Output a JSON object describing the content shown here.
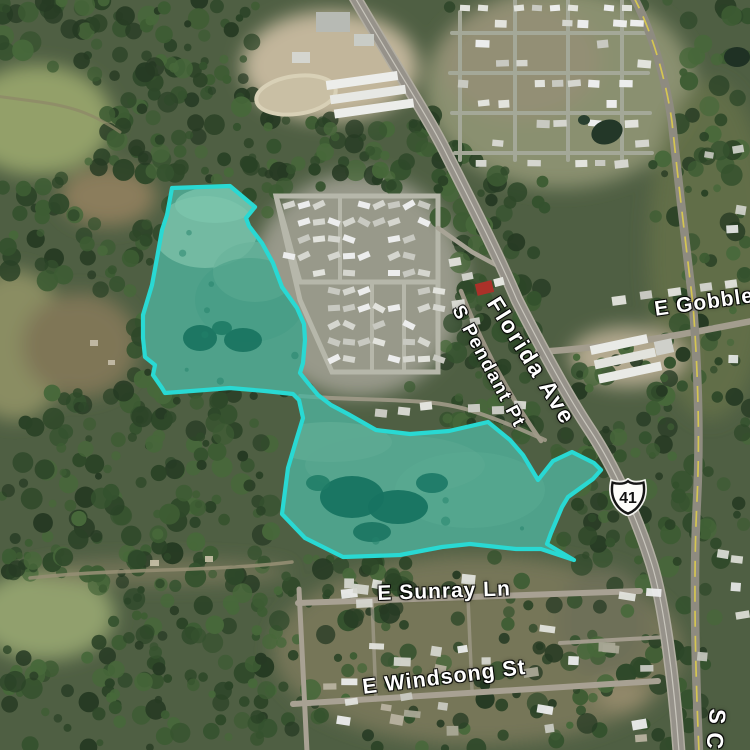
{
  "map": {
    "view": "satellite",
    "labels": {
      "florida_ave": "Florida Ave",
      "s_pendant_pt": "S Pendant Pt",
      "e_gobbler": "E Gobbler",
      "e_sunray_ln": "E Sunray Ln",
      "e_windsong_st": "E Windsong St",
      "s_street_partial": "S C",
      "route_shield_number": "41"
    },
    "overlay": {
      "description": "highlighted wetland parcel, two connected lobes",
      "stroke_color": "#29d9d3",
      "stroke_width": 4.2,
      "fill_color": "rgba(0,205,185,0.40)",
      "points": [
        [
          172,
          188
        ],
        [
          230,
          186
        ],
        [
          255,
          207
        ],
        [
          246,
          218
        ],
        [
          249,
          226
        ],
        [
          262,
          243
        ],
        [
          273,
          263
        ],
        [
          282,
          287
        ],
        [
          297,
          308
        ],
        [
          304,
          324
        ],
        [
          305,
          340
        ],
        [
          303,
          363
        ],
        [
          300,
          373
        ],
        [
          308,
          383
        ],
        [
          318,
          395
        ],
        [
          331,
          405
        ],
        [
          348,
          414
        ],
        [
          376,
          430
        ],
        [
          410,
          434
        ],
        [
          449,
          431
        ],
        [
          488,
          422
        ],
        [
          510,
          440
        ],
        [
          523,
          455
        ],
        [
          538,
          480
        ],
        [
          553,
          461
        ],
        [
          572,
          452
        ],
        [
          594,
          463
        ],
        [
          601,
          470
        ],
        [
          593,
          479
        ],
        [
          568,
          497
        ],
        [
          562,
          507
        ],
        [
          551,
          533
        ],
        [
          547,
          544
        ],
        [
          574,
          560
        ],
        [
          541,
          549
        ],
        [
          516,
          549
        ],
        [
          470,
          544
        ],
        [
          442,
          547
        ],
        [
          400,
          555
        ],
        [
          343,
          557
        ],
        [
          305,
          538
        ],
        [
          282,
          514
        ],
        [
          288,
          468
        ],
        [
          296,
          441
        ],
        [
          303,
          418
        ],
        [
          299,
          400
        ],
        [
          293,
          394
        ],
        [
          265,
          391
        ],
        [
          230,
          388
        ],
        [
          205,
          390
        ],
        [
          165,
          393
        ],
        [
          162,
          388
        ],
        [
          153,
          375
        ],
        [
          155,
          365
        ],
        [
          145,
          357
        ],
        [
          143,
          338
        ],
        [
          143,
          315
        ],
        [
          152,
          285
        ],
        [
          157,
          258
        ],
        [
          162,
          230
        ],
        [
          167,
          215
        ]
      ]
    }
  }
}
